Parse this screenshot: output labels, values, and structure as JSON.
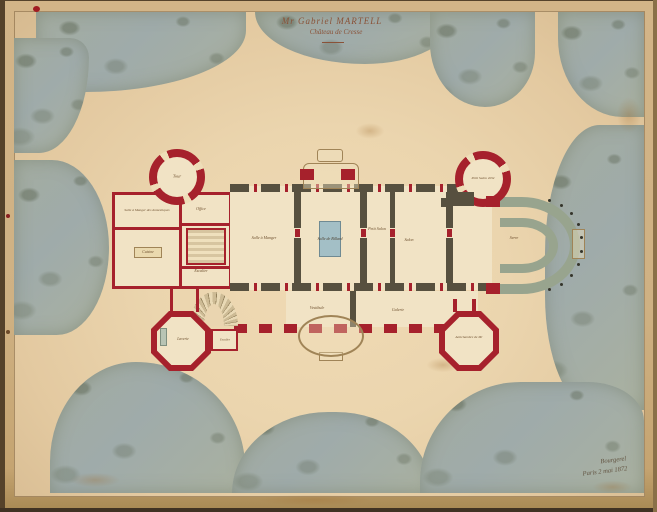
{
  "artwork": {
    "title": {
      "line1": "Mr Gabriel MARTELL",
      "line2": "Château de Cresse"
    },
    "signature": {
      "line1": "Bourgerel",
      "line2": "Paris 2 mai 1872"
    }
  },
  "rooms": [
    {
      "id": "tour",
      "label": "Tour"
    },
    {
      "id": "salle-manger-domestiques",
      "label": "Salle à Manger des domestiques"
    },
    {
      "id": "office",
      "label": "Office"
    },
    {
      "id": "cuisine",
      "label": "Cuisine"
    },
    {
      "id": "escalier-service",
      "label": "Escalier"
    },
    {
      "id": "salle-a-manger",
      "label": "Salle à Manger"
    },
    {
      "id": "salle-de-billard",
      "label": "Salle de Billard"
    },
    {
      "id": "petit-salon",
      "label": "Petit Salon"
    },
    {
      "id": "salon",
      "label": "Salon"
    },
    {
      "id": "petit-salon-ete",
      "label": "Petit Salon d'été"
    },
    {
      "id": "serre",
      "label": "Serre"
    },
    {
      "id": "vestibule",
      "label": "Vestibule"
    },
    {
      "id": "galerie",
      "label": "Galerie"
    },
    {
      "id": "laverie",
      "label": "Laverie"
    },
    {
      "id": "escalier-pavillon",
      "label": "Escalier"
    },
    {
      "id": "antichambre",
      "label": "Antichambre de Mr"
    }
  ],
  "colors": {
    "mount_paper": "#cfb183",
    "sheet_paper": "#ebd5ae",
    "garden_wash": "#a6afa3",
    "wall_new_red": "#a6212c",
    "wall_old_dark": "#57503f",
    "room_fill": "#f1e3c5",
    "billiard_table_blue": "#a3bfc6",
    "conservatory_green": "#98a48e",
    "ink_brown": "#6d4f2e"
  }
}
